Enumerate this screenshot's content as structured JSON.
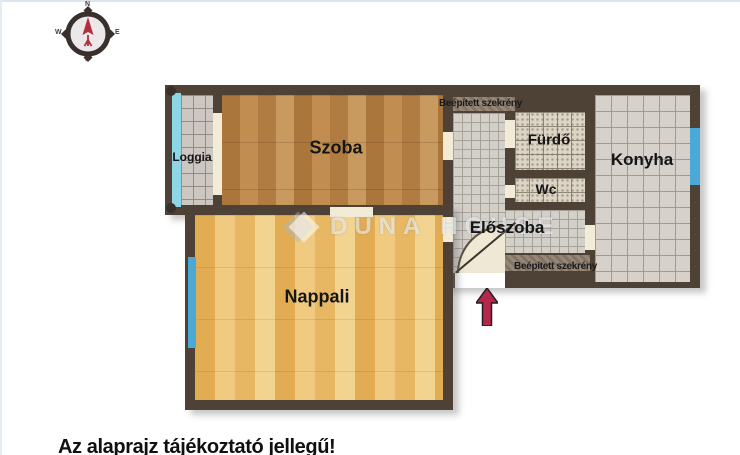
{
  "compass": {
    "north": "N",
    "east": "E",
    "south": "S",
    "west": "W"
  },
  "watermark": {
    "brand": "DUNA HOUSE"
  },
  "rooms": {
    "loggia": {
      "label": "Loggia"
    },
    "szoba": {
      "label": "Szoba"
    },
    "furdo": {
      "label": "Fürdő"
    },
    "wc": {
      "label": "Wc"
    },
    "konyha": {
      "label": "Konyha"
    },
    "eloszoba": {
      "label": "Előszoba"
    },
    "nappali": {
      "label": "Nappali"
    }
  },
  "closets": {
    "top": "Beépített szekrény",
    "bottom": "Beépített szekrény"
  },
  "footer": {
    "disclaimer": "Az alaprajz tájékoztató jellegű!"
  },
  "colors": {
    "wall": "#4e4136",
    "szoba_floor": "#b5834a",
    "nappali_floor": "#eabf6e",
    "tile_grey": "#d4d0ca",
    "window_blue": "#4aa9d6",
    "loggia_window": "#8ed6e6",
    "door_cream": "#f2ebd6",
    "arrow_red": "#b5274b"
  }
}
